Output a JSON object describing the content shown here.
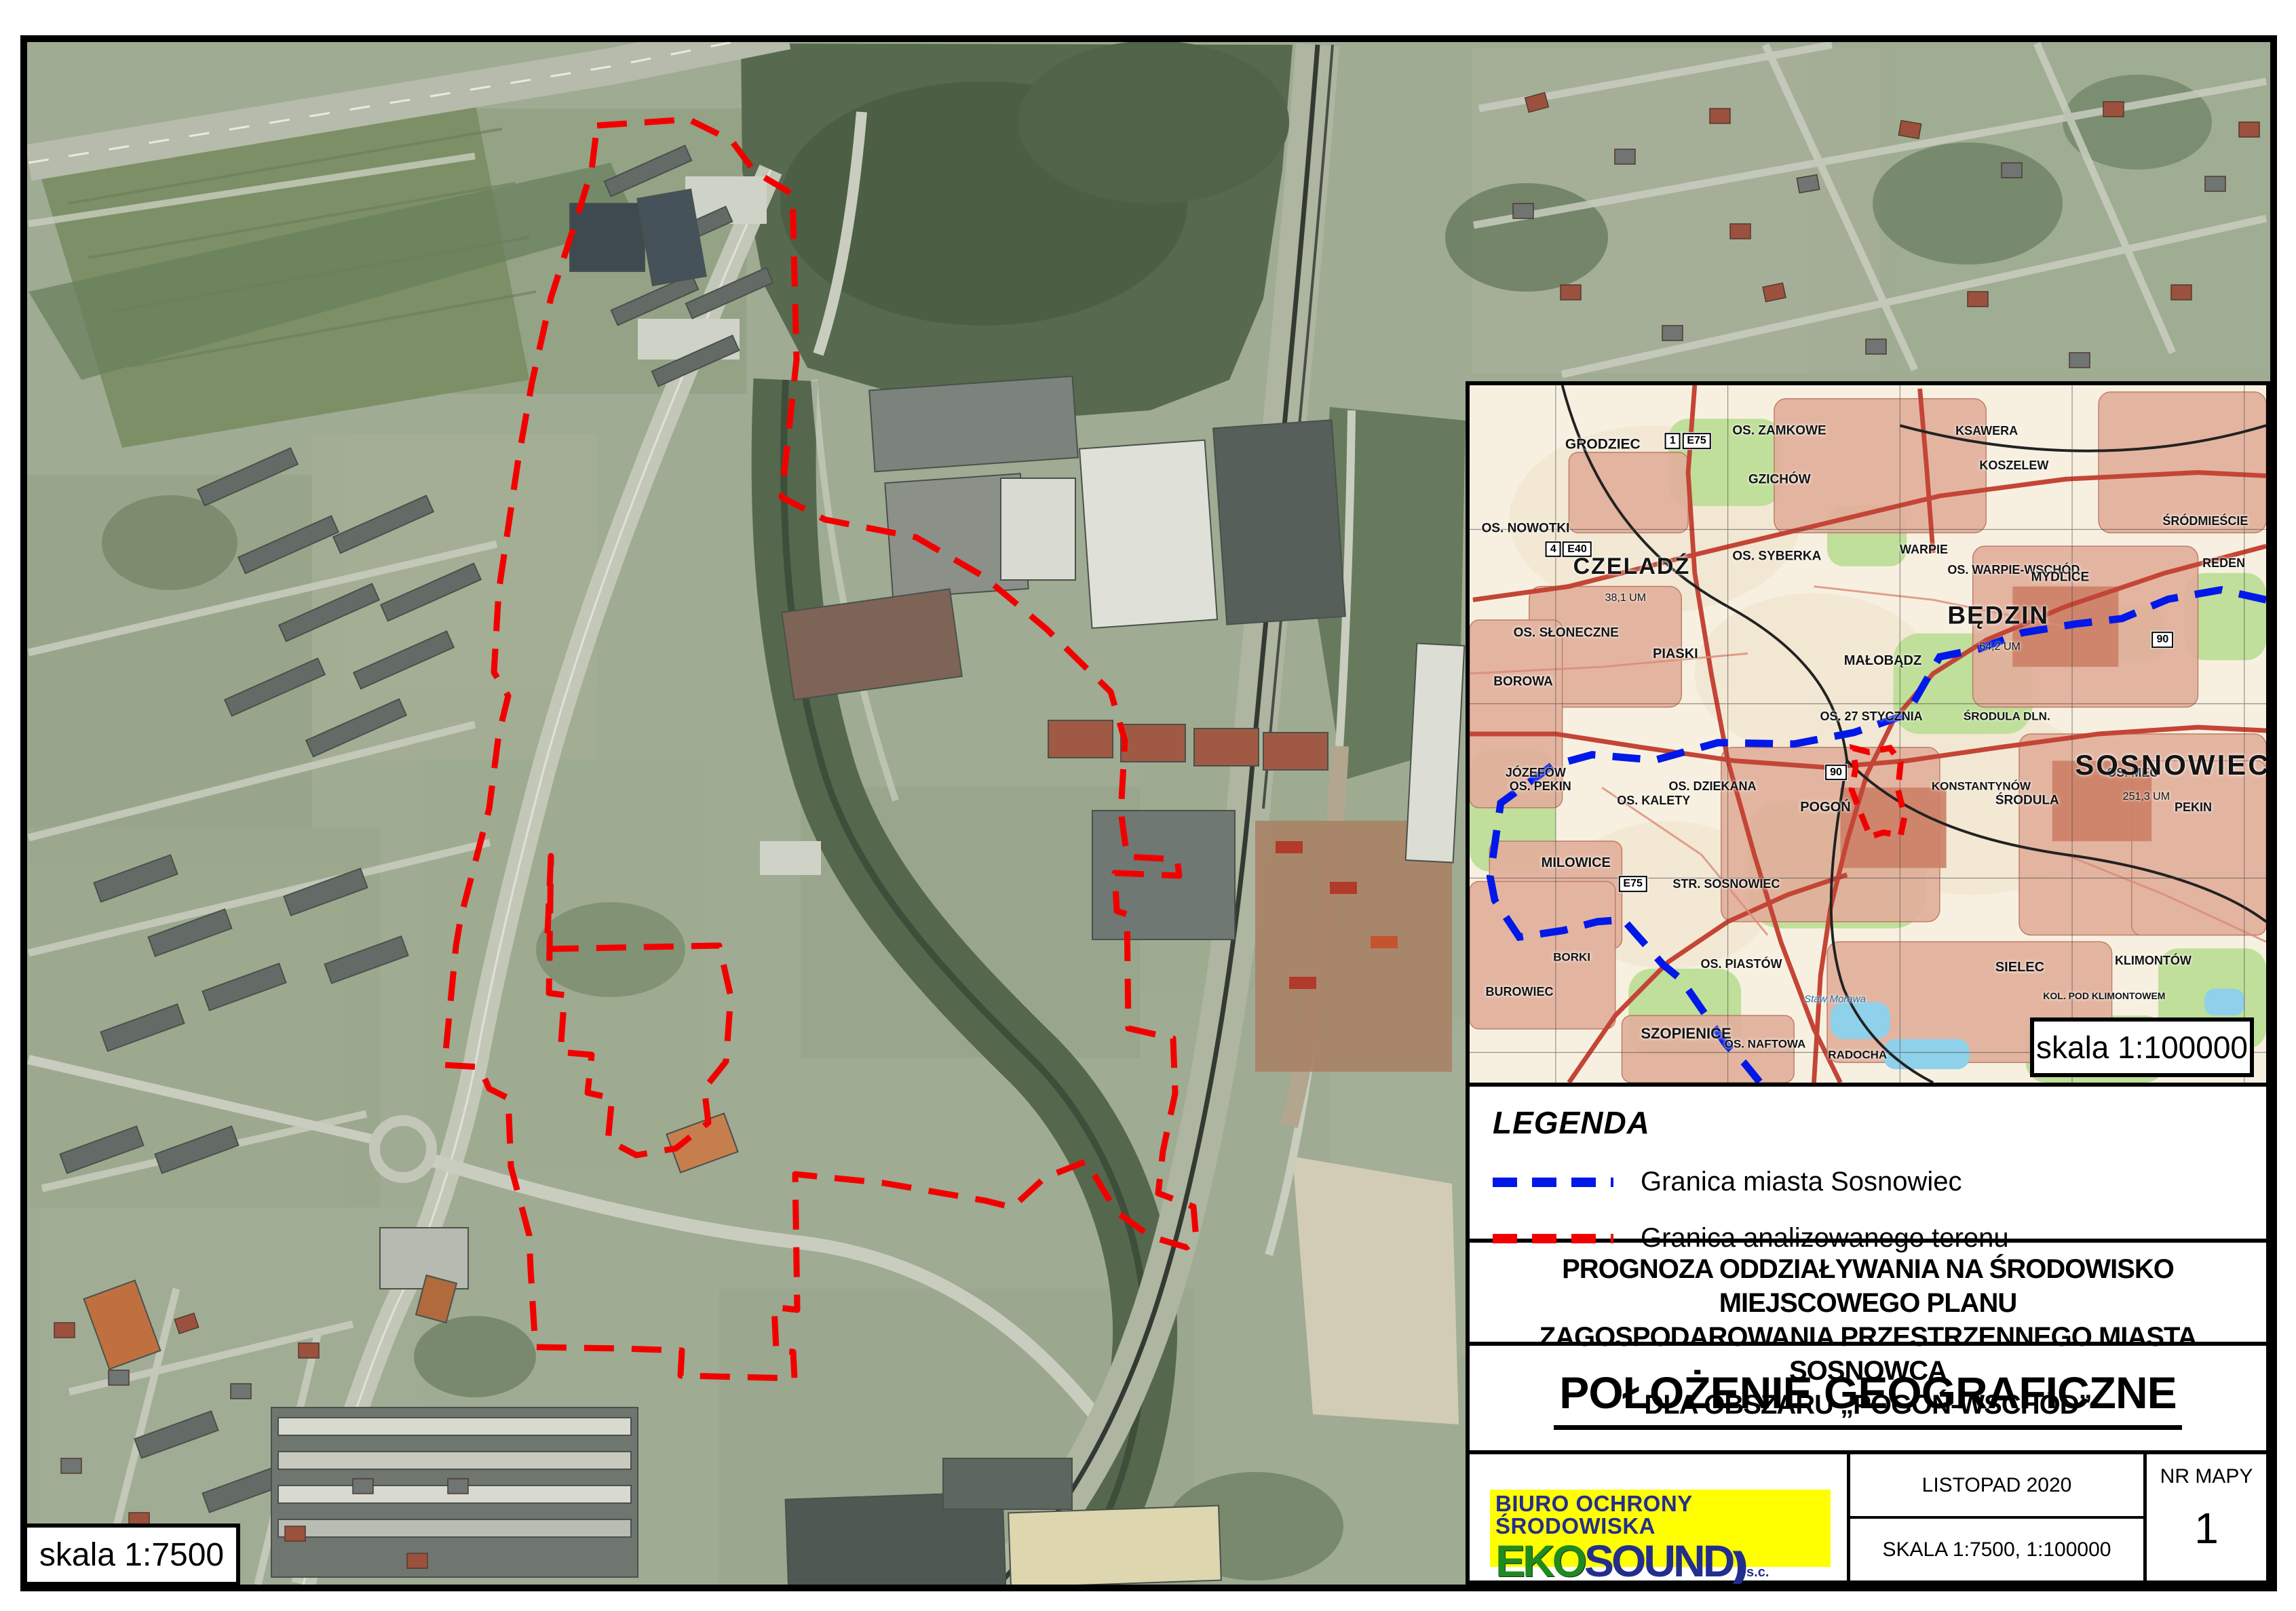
{
  "colors": {
    "boundary-red": "#f20000",
    "boundary-blue": "#0018e8",
    "logo-yellow": "#ffff00",
    "logo-green": "#1f8a1f",
    "logo-navy": "#232e8c",
    "topo-road-red": "#c44536",
    "topo-urban-pink": "#e2b09c"
  },
  "main_map": {
    "scale_label": "skala 1:7500"
  },
  "inset": {
    "scale_label": "skala 1:100000",
    "labels": [
      {
        "text": "GRODZIEC",
        "x": "12%",
        "y": "8.5%",
        "size": "21px",
        "weight": "600"
      },
      {
        "text": "OS. ZAMKOWE",
        "x": "33%",
        "y": "6.5%",
        "size": "19px",
        "weight": "600"
      },
      {
        "text": "GZICHÓW",
        "x": "35%",
        "y": "13.5%",
        "size": "19px",
        "weight": "600"
      },
      {
        "text": "OS. NOWOTKI",
        "x": "1.5%",
        "y": "20.5%",
        "size": "19px",
        "weight": "600"
      },
      {
        "text": "CZELADŹ",
        "x": "13%",
        "y": "26%",
        "size": "34px",
        "weight": "700",
        "spacing": "2px"
      },
      {
        "text": "38,1 UM",
        "x": "17%",
        "y": "30.5%",
        "size": "16px",
        "weight": "400"
      },
      {
        "text": "OS. SYBERKA",
        "x": "33%",
        "y": "24.5%",
        "size": "19px",
        "weight": "600"
      },
      {
        "text": "OS. SŁONECZNE",
        "x": "5.5%",
        "y": "35.5%",
        "size": "19px",
        "weight": "600"
      },
      {
        "text": "PIASKI",
        "x": "23%",
        "y": "38.5%",
        "size": "20px",
        "weight": "600"
      },
      {
        "text": "MAŁOBĄDZ",
        "x": "47%",
        "y": "39.5%",
        "size": "20px",
        "weight": "600"
      },
      {
        "text": "BOROWA",
        "x": "3%",
        "y": "42.5%",
        "size": "19px",
        "weight": "600"
      },
      {
        "text": "JÓZEFÓW",
        "x": "4.5%",
        "y": "55.5%",
        "size": "18px",
        "weight": "600"
      },
      {
        "text": "OS. DZIEKANA",
        "x": "25%",
        "y": "57.5%",
        "size": "18px",
        "weight": "600"
      },
      {
        "text": "OS. 27 STYCZNIA",
        "x": "44%",
        "y": "47.5%",
        "size": "18px",
        "weight": "600"
      },
      {
        "text": "KSAWERA",
        "x": "61%",
        "y": "6.5%",
        "size": "18px",
        "weight": "600"
      },
      {
        "text": "KOSZELEW",
        "x": "64%",
        "y": "11.5%",
        "size": "18px",
        "weight": "600"
      },
      {
        "text": "WARPIE",
        "x": "54%",
        "y": "23.5%",
        "size": "18px",
        "weight": "600"
      },
      {
        "text": "OS. WARPIE-WSCHÓD",
        "x": "60%",
        "y": "26.5%",
        "size": "18px",
        "weight": "600"
      },
      {
        "text": "MYDLICE",
        "x": "70.5%",
        "y": "27.5%",
        "size": "19px",
        "weight": "600"
      },
      {
        "text": "ŚRÓDMIEŚCIE",
        "x": "87%",
        "y": "19.5%",
        "size": "18px",
        "weight": "600"
      },
      {
        "text": "REDEN",
        "x": "92%",
        "y": "25.5%",
        "size": "18px",
        "weight": "600"
      },
      {
        "text": "BĘDZIN",
        "x": "60%",
        "y": "33%",
        "size": "37px",
        "weight": "700",
        "spacing": "2px"
      },
      {
        "text": "64,2 UM",
        "x": "64%",
        "y": "37.5%",
        "size": "16px",
        "weight": "400"
      },
      {
        "text": "ŚRODULA DLN.",
        "x": "62%",
        "y": "47.5%",
        "size": "17px",
        "weight": "600"
      },
      {
        "text": "OS. MEC",
        "x": "80%",
        "y": "55.5%",
        "size": "18px",
        "weight": "600"
      },
      {
        "text": "ŚRODULA",
        "x": "66%",
        "y": "59.5%",
        "size": "19px",
        "weight": "600"
      },
      {
        "text": "OS. PEKIN",
        "x": "5%",
        "y": "57.5%",
        "size": "18px",
        "weight": "600"
      },
      {
        "text": "OS. KALETY",
        "x": "18.5%",
        "y": "59.5%",
        "size": "18px",
        "weight": "600"
      },
      {
        "text": "MILOWICE",
        "x": "9%",
        "y": "68.5%",
        "size": "20px",
        "weight": "600"
      },
      {
        "text": "STR. SOSNOWIEC",
        "x": "25.5%",
        "y": "71.5%",
        "size": "18px",
        "weight": "600"
      },
      {
        "text": "POGOŃ",
        "x": "41.5%",
        "y": "60.5%",
        "size": "20px",
        "weight": "600"
      },
      {
        "text": "OS. PIASTÓW",
        "x": "29%",
        "y": "83%",
        "size": "18px",
        "weight": "600"
      },
      {
        "text": "SZOPIENICE",
        "x": "21.5%",
        "y": "93%",
        "size": "22px",
        "weight": "600"
      },
      {
        "text": "BUROWIEC",
        "x": "2%",
        "y": "87%",
        "size": "18px",
        "weight": "600"
      },
      {
        "text": "BORKI",
        "x": "10.5%",
        "y": "82%",
        "size": "17px",
        "weight": "600"
      },
      {
        "text": "SOSNOWIEC",
        "x": "76%",
        "y": "54.5%",
        "size": "42px",
        "weight": "700",
        "spacing": "3px"
      },
      {
        "text": "251,3 UM",
        "x": "82%",
        "y": "59%",
        "size": "16px",
        "weight": "400"
      },
      {
        "text": "KONSTANTYNÓW",
        "x": "58%",
        "y": "57.5%",
        "size": "17px",
        "weight": "600"
      },
      {
        "text": "PEKIN",
        "x": "88.5%",
        "y": "60.5%",
        "size": "18px",
        "weight": "600"
      },
      {
        "text": "SIELEC",
        "x": "66%",
        "y": "83.5%",
        "size": "20px",
        "weight": "600"
      },
      {
        "text": "KLIMONTÓW",
        "x": "81%",
        "y": "82.5%",
        "size": "18px",
        "weight": "600"
      },
      {
        "text": "KOL. POD KLIMONTOWEM",
        "x": "72%",
        "y": "87.5%",
        "size": "14px",
        "weight": "600"
      },
      {
        "text": "RADOCHA",
        "x": "45%",
        "y": "96%",
        "size": "17px",
        "weight": "600"
      },
      {
        "text": "OS. NAFTOWA",
        "x": "32%",
        "y": "94.5%",
        "size": "17px",
        "weight": "600"
      },
      {
        "text": "Staw Morawa",
        "x": "42%",
        "y": "88%",
        "size": "15px",
        "weight": "400",
        "style": "italic",
        "color": "#1c6fa8"
      }
    ],
    "badges": [
      {
        "text": "1",
        "x": "25.5%",
        "y": "8%"
      },
      {
        "text": "E75",
        "x": "28.5%",
        "y": "8%"
      },
      {
        "text": "4",
        "x": "10.5%",
        "y": "23.5%"
      },
      {
        "text": "E40",
        "x": "13.5%",
        "y": "23.5%"
      },
      {
        "text": "90",
        "x": "87%",
        "y": "36.5%"
      },
      {
        "text": "90",
        "x": "46%",
        "y": "55.5%"
      },
      {
        "text": "E75",
        "x": "20.5%",
        "y": "71.5%"
      }
    ]
  },
  "legend": {
    "title": "LEGENDA",
    "items": [
      {
        "label": "Granica miasta Sosnowiec",
        "color": "#0018e8"
      },
      {
        "label": "Granica analizowanego terenu",
        "color": "#f20000"
      }
    ]
  },
  "titles": {
    "line1": "PROGNOZA ODDZIAŁYWANIA NA ŚRODOWISKO MIEJSCOWEGO PLANU",
    "line2": "ZAGOSPODAROWANIA PRZESTRZENNEGO MIASTA SOSNOWCA",
    "line3": "DLA OBSZARU „POGOŃ-WSCHÓD”",
    "map_title": "POŁOŻENIE GEOGRAFICZNE"
  },
  "footer": {
    "company": "BIURO OCHRONY ŚRODOWISKA",
    "logo": {
      "eko": "EKO",
      "sound": "SOUND",
      "arcs": "))",
      "suffix": "s.c."
    },
    "date": "LISTOPAD 2020",
    "scale_text": "SKALA 1:7500, 1:100000",
    "map_no_label": "NR MAPY",
    "map_no": "1"
  }
}
